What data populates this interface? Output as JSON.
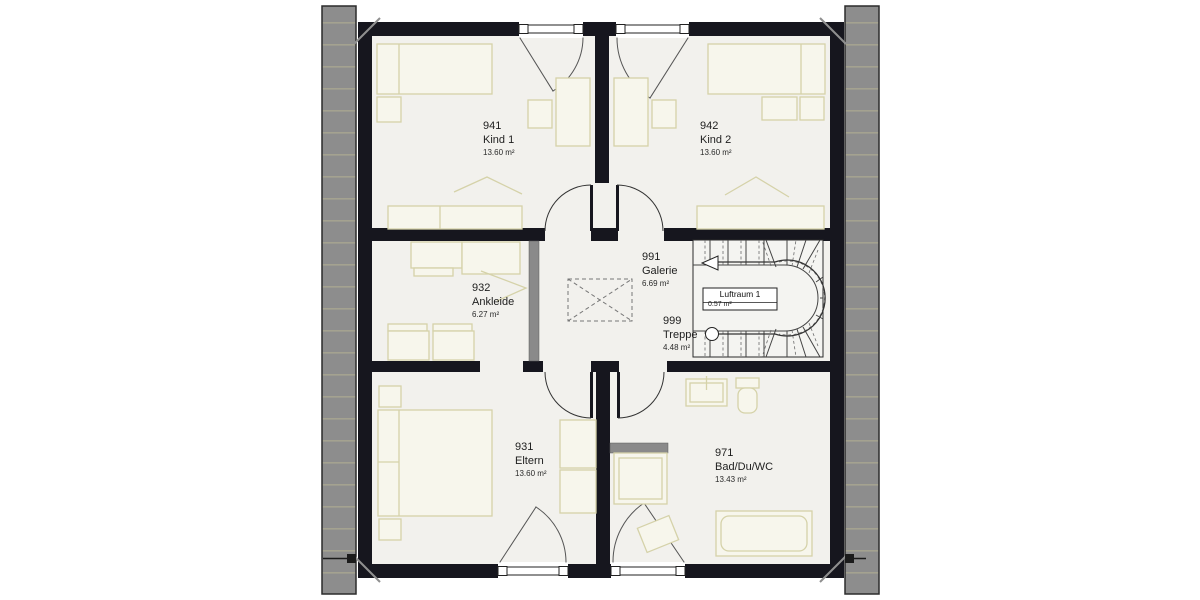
{
  "plan": {
    "rooms": [
      {
        "id": "941",
        "name": "Kind 1",
        "area": "13.60 m²"
      },
      {
        "id": "942",
        "name": "Kind 2",
        "area": "13.60 m²"
      },
      {
        "id": "932",
        "name": "Ankleide",
        "area": "6.27 m²"
      },
      {
        "id": "991",
        "name": "Galerie",
        "area": "6.69 m²"
      },
      {
        "id": "999",
        "name": "Treppe",
        "area": "4.48 m²"
      },
      {
        "id": "931",
        "name": "Eltern",
        "area": "13.60 m²"
      },
      {
        "id": "971",
        "name": "Bad/Du/WC",
        "area": "13.43 m²"
      }
    ],
    "void": {
      "name": "Luftraum 1",
      "area": "0.57 m²"
    },
    "colors": {
      "wall": "#16161e",
      "floor": "#f2f1ed",
      "furniture_stroke": "#d5d2a9",
      "roof_strip": "#8d8d8d",
      "partition_gray": "#8a8a8a"
    }
  }
}
